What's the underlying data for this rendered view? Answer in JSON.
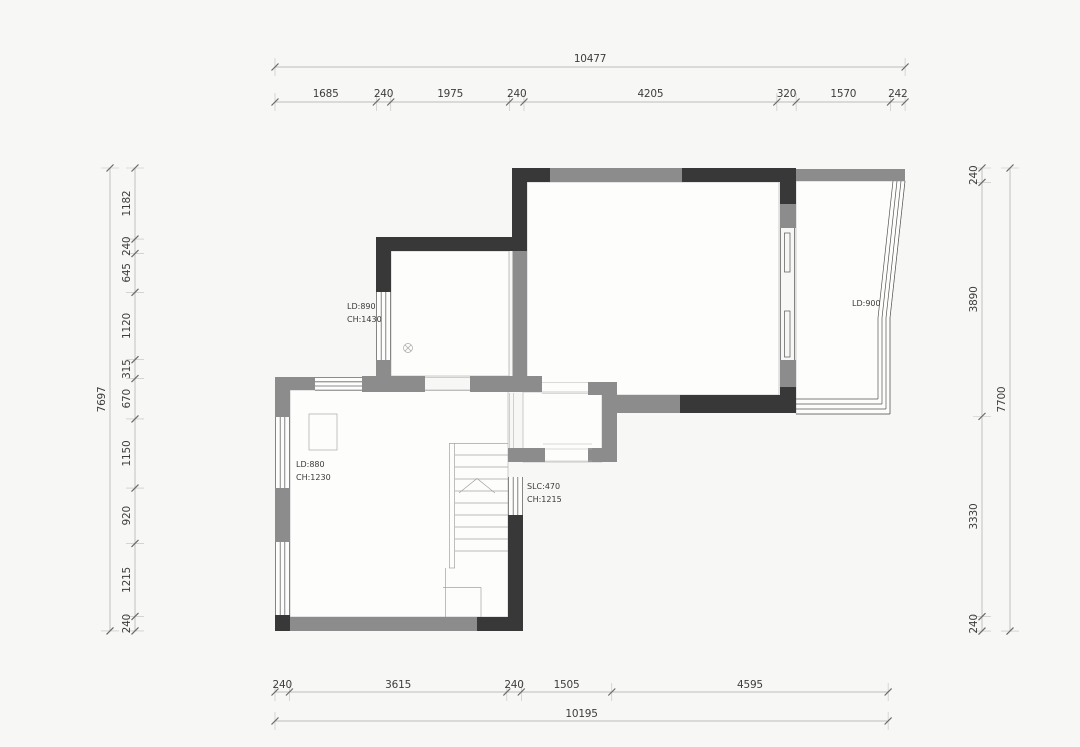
{
  "title": "floor-plan-with-dimension-chains",
  "colors": {
    "wall_dark": "#383838",
    "wall_gray": "#8c8c8c",
    "background": "#f7f7f5",
    "dim_text": "#3d3d3d"
  },
  "dimensions": {
    "top": {
      "total": "10477",
      "segments": [
        "1685",
        "240",
        "1975",
        "240",
        "4205",
        "320",
        "1570",
        "242"
      ]
    },
    "bottom": {
      "total": "10195",
      "segments": [
        "240",
        "3615",
        "240",
        "1505",
        "4595"
      ]
    },
    "left": {
      "total": "7697",
      "segments": [
        "1182",
        "240",
        "645",
        "1120",
        "315",
        "670",
        "1150",
        "920",
        "1215",
        "240"
      ]
    },
    "right": {
      "total": "7700",
      "segments": [
        "240",
        "3890",
        "3330",
        "240"
      ]
    }
  },
  "annotations": {
    "window_upper_left": {
      "line1": "LD:890",
      "line2": "CH:1430"
    },
    "balcony_window": {
      "line1": "LD:900"
    },
    "window_lower_left": {
      "line1": "LD:880",
      "line2": "CH:1230"
    },
    "stair_window": {
      "line1": "SLC:470",
      "line2": "CH:1215"
    }
  }
}
